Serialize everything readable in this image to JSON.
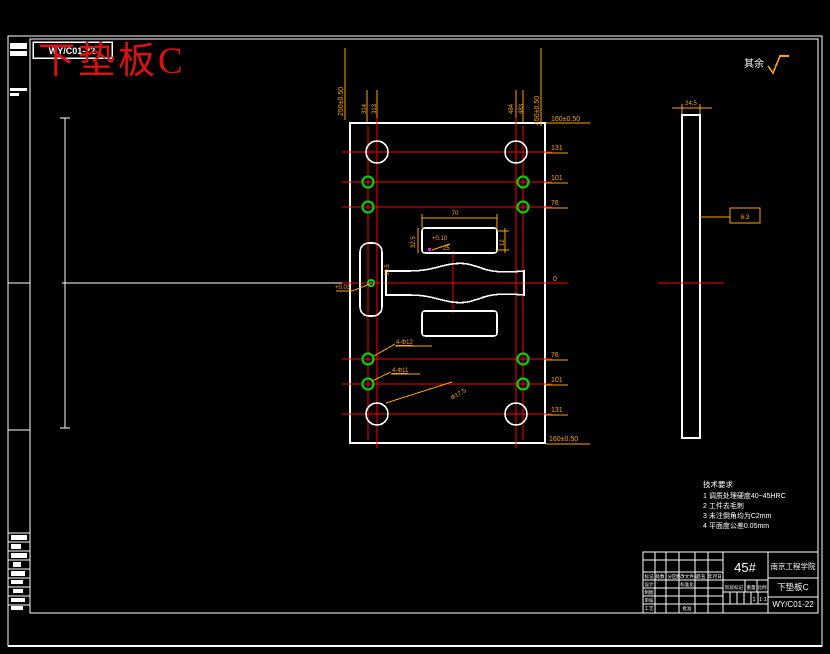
{
  "frame": {
    "code_box": "WY/C01-22",
    "sheet_title": "下垫板C",
    "rest_label": "其余"
  },
  "notes": {
    "title": "技术要求",
    "items": [
      "1  调质处理硬度40~45HRC",
      "2  工件去毛刺",
      "3  未注倒角均为C2mm",
      "4  平面度公差0.05mm"
    ]
  },
  "dims": {
    "left_height": "250±0.50",
    "x_left_a": "314",
    "x_left_b": "313",
    "x_right_a": "484",
    "x_right_b": "483",
    "right_height": "450±0.50",
    "ord_top": "160±0.50",
    "ord_131_top": "131",
    "ord_101_top": "101",
    "ord_76_top": "76",
    "ord_0": "0",
    "ord_76_bot": "76",
    "ord_101_bot": "101",
    "ord_131_bot": "131",
    "ord_bot": "160±0.50",
    "big_hole": "Φ17.5",
    "green_hole_a": "4-Φ12",
    "green_hole_b": "4-Φ11",
    "slot_width": "70",
    "slot_height": "32.5",
    "slot_radius": "25",
    "slot_side": "12",
    "slot_tol": "+0.10",
    "left_slot_len": "30.5",
    "left_slot_tol": "+0.03",
    "side_thickness": "24.5",
    "side_finish": "6.3"
  },
  "title_block": {
    "material": "45#",
    "org": "南京工程学院",
    "part": "下垫板C",
    "code": "WY/C01-22",
    "mid_labels": [
      "阶段标记",
      "重量",
      "比例"
    ],
    "qty": "1",
    "scale": "1:1",
    "grid": [
      [
        "标记",
        "处数",
        "分区",
        "更改文件号",
        "签名",
        "年月日"
      ],
      [
        "设计",
        "",
        "",
        "标准化",
        "",
        ""
      ],
      [
        "制图",
        "",
        "",
        "",
        "",
        ""
      ],
      [
        "审核",
        "",
        "",
        "",
        "",
        ""
      ],
      [
        "工艺",
        "",
        "",
        "批准",
        "",
        ""
      ]
    ]
  }
}
